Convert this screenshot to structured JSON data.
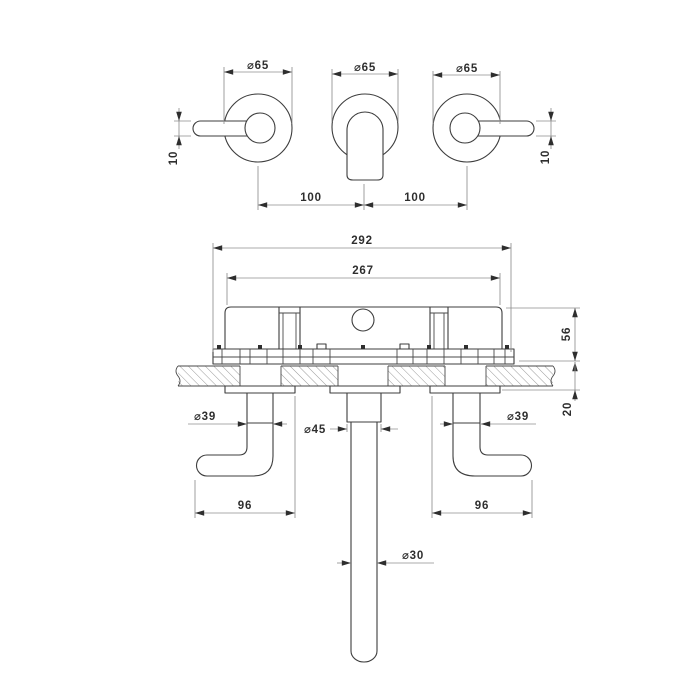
{
  "front_view": {
    "dia_left": "⌀65",
    "dia_center": "⌀65",
    "dia_right": "⌀65",
    "lever_left": "10",
    "lever_right": "10",
    "pitch_left": "100",
    "pitch_right": "100"
  },
  "section_view": {
    "overall_width": "292",
    "body_width": "267",
    "depth": "56",
    "wall_range": "20",
    "dia_trim_left": "⌀39",
    "dia_trim_center": "⌀45",
    "dia_trim_right": "⌀39",
    "handle_left": "96",
    "handle_right": "96",
    "dia_spout": "⌀30"
  }
}
